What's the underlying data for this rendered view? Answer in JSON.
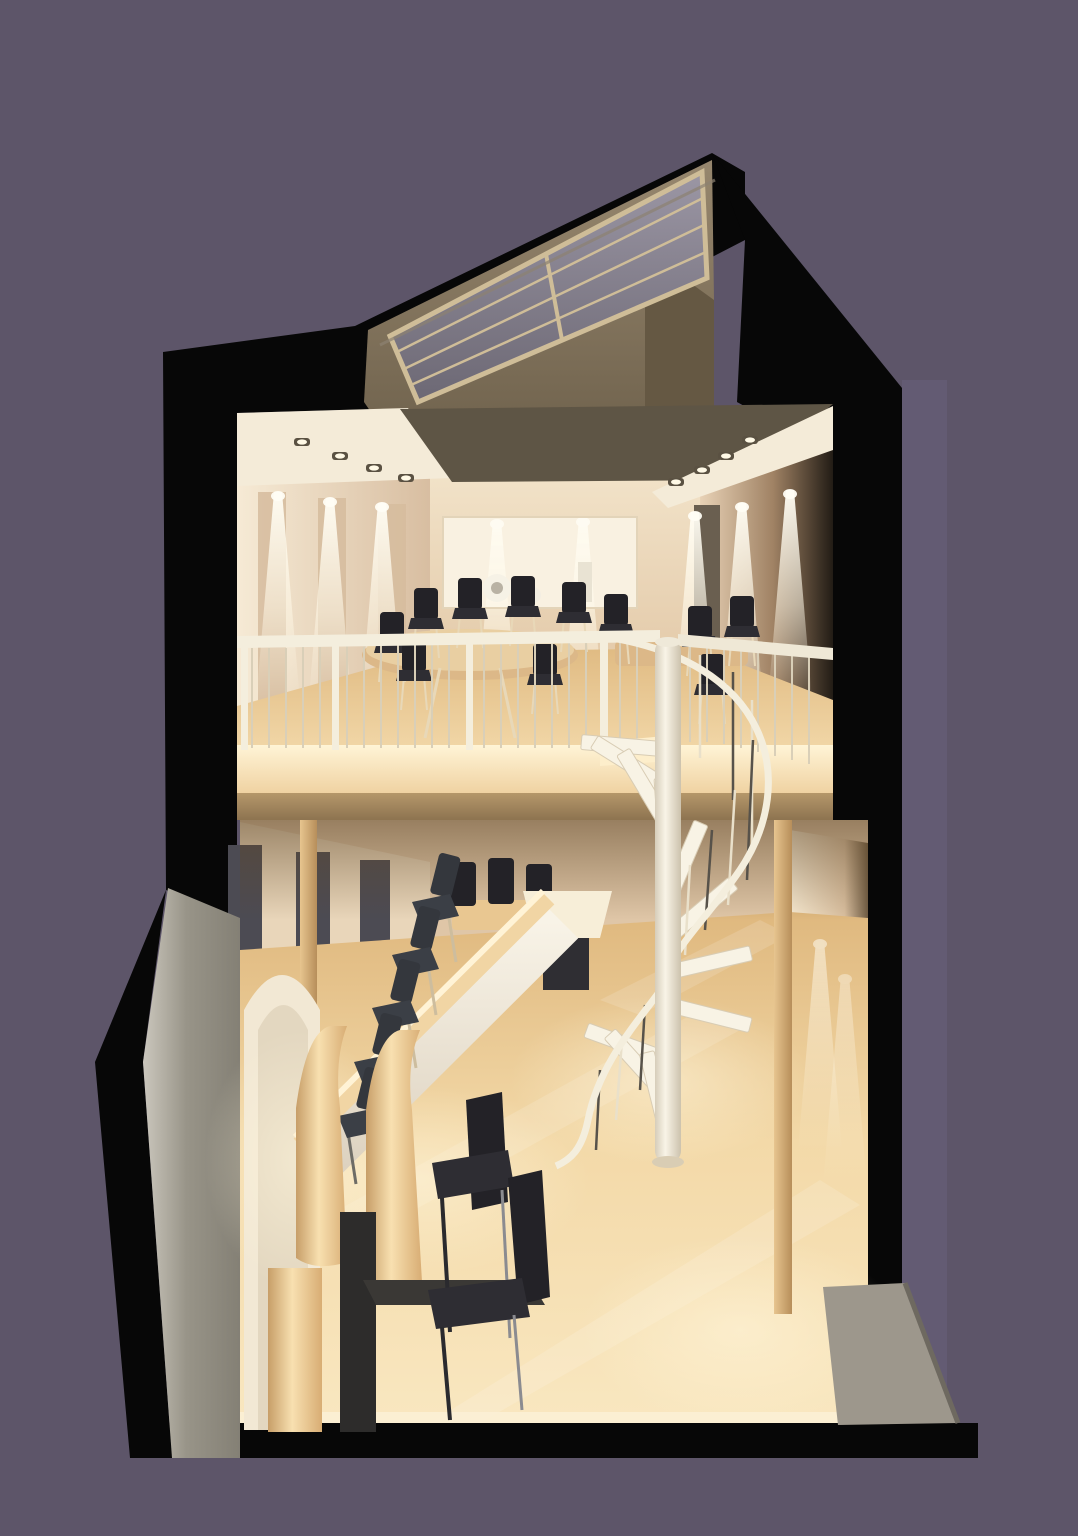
{
  "scene": {
    "type": "architectural-cutaway-render",
    "description": "Sectional 3D rendering of a two-storey cafe interior: slanted skylight dormer on top, mezzanine dining level with round table, black chairs and metal railing, white spiral staircase connecting to ground floor with long counter, bar stools, curved wood reception desk and two black chairs, on a plain purple backdrop",
    "levels": [
      {
        "name": "mezzanine",
        "features": [
          "round-dining-table",
          "side-dining-table",
          "black-chairs",
          "guard-railing",
          "display-niche",
          "wall-washer-lights",
          "recessed-downlights"
        ]
      },
      {
        "name": "ground-floor",
        "features": [
          "long-counter",
          "bar-stools",
          "small-table",
          "shade-table",
          "curved-reception-desk",
          "guest-chairs",
          "entry-mat",
          "wood-flooring"
        ]
      }
    ],
    "counts": {
      "counter_stools": 5,
      "mezzanine_chairs_left": 7,
      "mezzanine_chairs_right": 3,
      "guest_chairs": 2,
      "wall_light_cones_left": 3,
      "wall_light_cones_right": 3,
      "niche_cones": 2,
      "skylight_mullions": 3
    }
  },
  "palette": {
    "background": "#5d5569",
    "background_soft": "#6b6380",
    "shell_black": "#070707",
    "dormer_face": "#8e7e66",
    "dormer_side": "#655843",
    "glass_hi": "#9b96a4",
    "glass_lo": "#6c6874",
    "mullion": "#cfbd98",
    "ceiling_panel": "#5e5545",
    "cove_white": "#f4ebd8",
    "wall_lit": "#f5e8d2",
    "wall_shade": "#d5bb9e",
    "back_wall": "#ecdcc2",
    "niche": "#f9f1e1",
    "cone_white": "#fffdf4",
    "mezz_wood": "#eecb96",
    "mezz_bright": "#fff2d2",
    "fascia": "#a88a5e",
    "table_wood": "#dcb888",
    "chair_dark": "#232227",
    "chair_seat": "#3b3f46",
    "rail_white": "#f4eedd",
    "baluster": "#d9cfb8",
    "baluster_dark": "#55504a",
    "stair_tread": "#f8f3e5",
    "stair_pole": "#efe9d9",
    "floor_light": "#f9e7c0",
    "floor_mid": "#edcd99",
    "floor_deep": "#ddb981",
    "counter_face": "#f5efe2",
    "counter_top": "#f1d5a4",
    "glow_warm": "#fff6dc",
    "gray_wall_light": "#c9c5bb",
    "gray_wall": "#908c81",
    "entry_mat": "#9d978c",
    "mat_edge": "#6e6960",
    "wood_post": "#d9b37d",
    "panel_dark": "#4c4b53",
    "desk_wood": "#f3d7a5",
    "desk_shade": "#c79e68",
    "slot_dark": "#2d2c2b"
  }
}
